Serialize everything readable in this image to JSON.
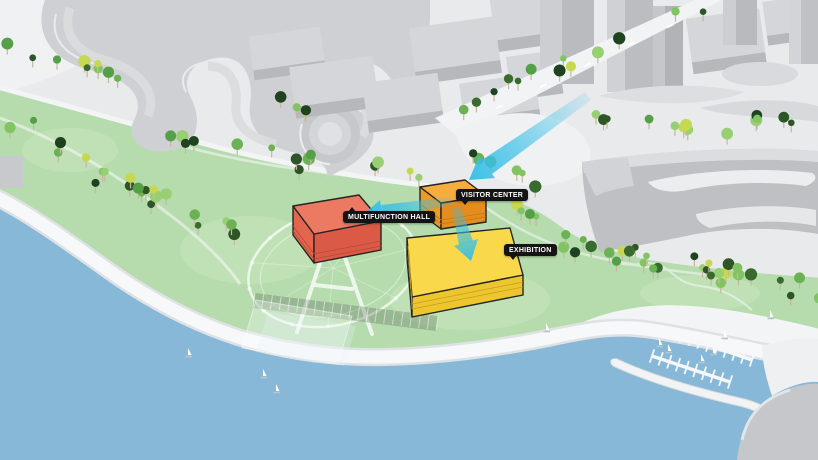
{
  "diagram": {
    "title": "waterfront site diagram",
    "labels": {
      "multifunction_hall": "MULTIFUNCTION HALL",
      "visitor_center": "VISITOR CENTER",
      "exhibition": "EXHIBITION"
    },
    "colors": {
      "water": "#87b8d7",
      "park": "#b6dcae",
      "parkLight": "#c8e5bd",
      "shore": "#f7f8fa",
      "cityGround": "#e9eaec",
      "street": "#f2f3f5",
      "blockTop": "#d5d6d9",
      "blockFront": "#b7b8bc",
      "hallTop": "#ec7a63",
      "hallLeft": "#e3654e",
      "hallFront": "#db5a45",
      "visitorTop": "#f7ac3e",
      "visitorLeft": "#ef9a24",
      "visitorFront": "#e58c1e",
      "exhibitionTop": "#f9d94b",
      "exhibitionLeft": "#f2cd39",
      "exhibitionFront": "#ecc52f",
      "arrow": "#35bfe7",
      "labelBg": "#141414",
      "labelText": "#ffffff",
      "outline": "#242424",
      "treeTrunk": "#c9b69c",
      "treePalette": [
        "#6cb254",
        "#82c464",
        "#97d073",
        "#2e5526",
        "#1f4220",
        "#c6d84f",
        "#55a047",
        "#3a6b2e"
      ]
    }
  }
}
